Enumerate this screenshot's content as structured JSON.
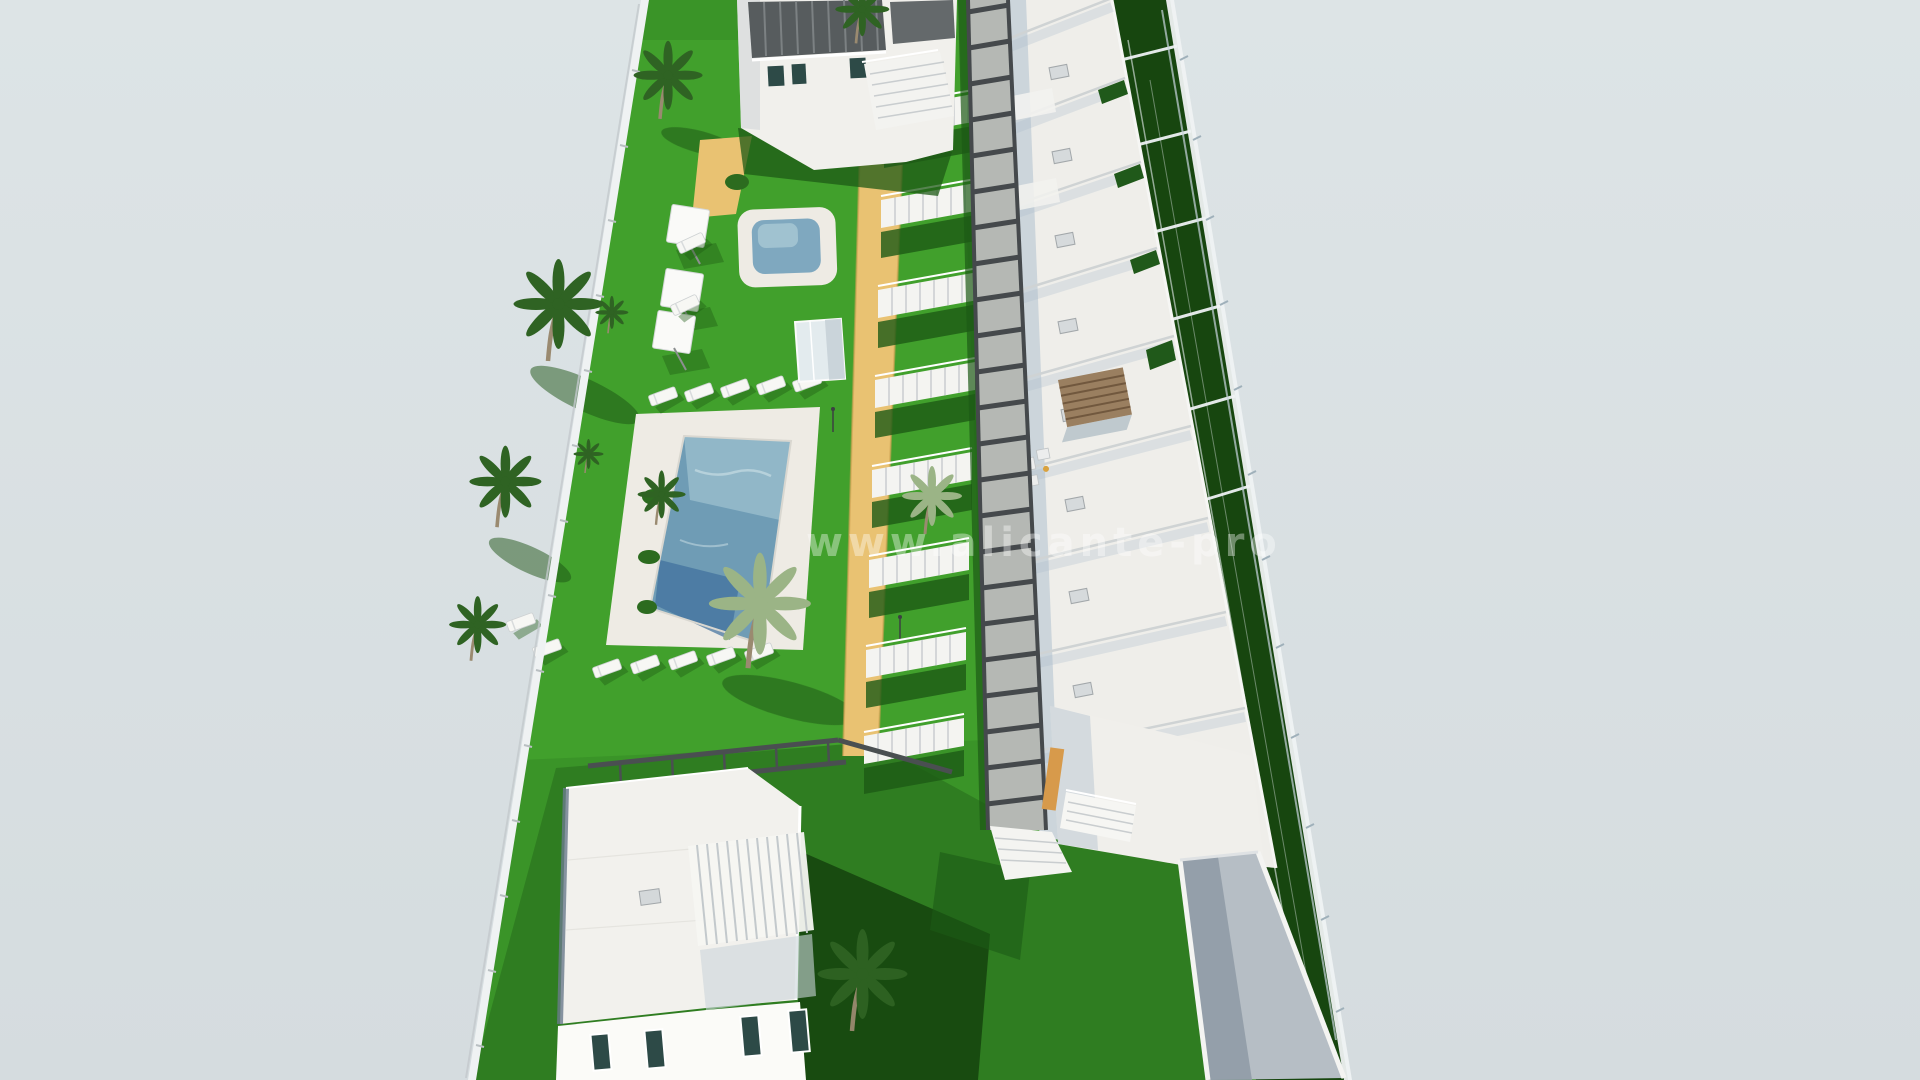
{
  "watermark": {
    "text": "www.alicante-pro"
  },
  "colors": {
    "sky": "#d9e0e2",
    "lawn": "#3a9428",
    "lawn_bright": "#47a930",
    "lawn_shadow": "#1d5a15",
    "lawn_dark": "#17460f",
    "sand": "#e9c272",
    "sand_shadow": "#cfa254",
    "roof_white": "#efeeea",
    "wall_white": "#f6f6f3",
    "wall_shade": "#cfd4d7",
    "shadow_blue": "#a9bccb",
    "pool_deck": "#eeebe4",
    "pool_water": "#6f9cb5",
    "pool_water_light": "#9cc0cf",
    "pool_water_dark": "#3f6f9d",
    "boardwalk": "#b5b8b4",
    "boardwalk_dark": "#45494c",
    "pergola_dark": "#575c5e",
    "pergola_wood": "#9a7f60",
    "palm_dark": "#2f6323",
    "palm_light": "#9bb486",
    "trunk": "#9a8a70",
    "fence": "#eff2f3",
    "ramp": "#b6bec5",
    "ramp_shadow": "#8e9aa5",
    "accent_orange": "#d79a4b",
    "window_glass": "#2d4a47",
    "railing_glass": "#6b7b8c"
  }
}
